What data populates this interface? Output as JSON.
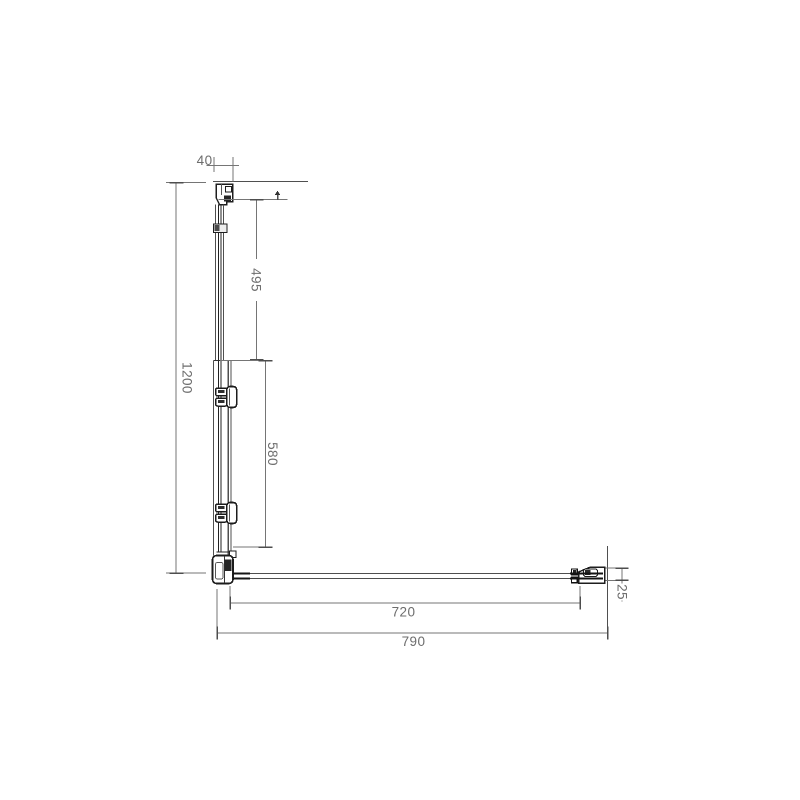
{
  "drawing": {
    "labels": {
      "bracket_width": "40",
      "upper_section_height": "495",
      "total_height": "1200",
      "lower_section_height": "580",
      "bar_span": "720",
      "total_width": "790",
      "end_offset": "25"
    },
    "colors": {
      "background": "#ffffff",
      "structure_dark": "#1e1e1e",
      "structure_light": "#4f4f4f",
      "dimension_line": "#757575",
      "label_text": "#6d6d6d"
    }
  }
}
